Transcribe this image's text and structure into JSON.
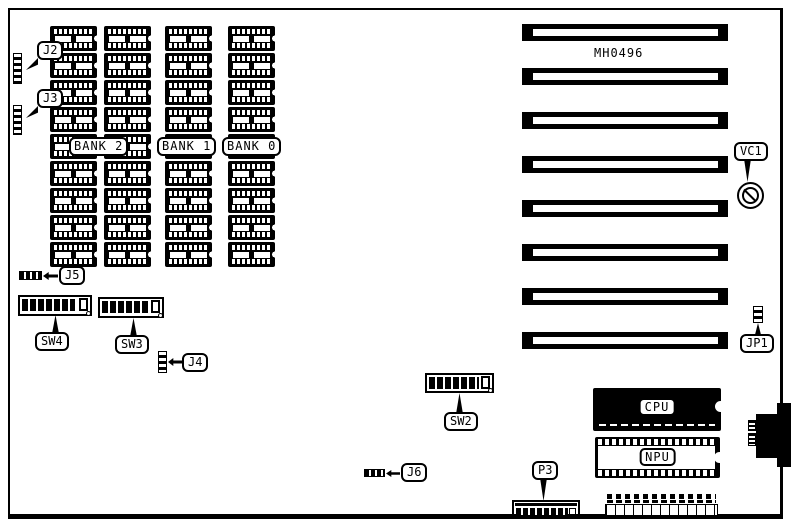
{
  "board": {
    "model": "MH0496"
  },
  "memory_array": {
    "rows": 9,
    "columns": 4,
    "chip_count": 36,
    "banks": [
      {
        "label": "BANK 2"
      },
      {
        "label": "BANK 1"
      },
      {
        "label": "BANK 0"
      }
    ]
  },
  "expansion_slots": {
    "count": 8
  },
  "callouts": {
    "j2": "J2",
    "j3": "J3",
    "j4": "J4",
    "j5": "J5",
    "j6": "J6",
    "jp1": "JP1",
    "p3": "P3",
    "vc1": "VC1",
    "sw2": "SW2",
    "sw3": "SW3",
    "sw4": "SW4"
  },
  "chips": {
    "cpu": "CPU",
    "npu": "NPU"
  },
  "dip_switches": [
    {
      "id": "SW4",
      "positions": 8
    },
    {
      "id": "SW3",
      "positions": 8
    },
    {
      "id": "SW2",
      "positions": 8
    }
  ]
}
